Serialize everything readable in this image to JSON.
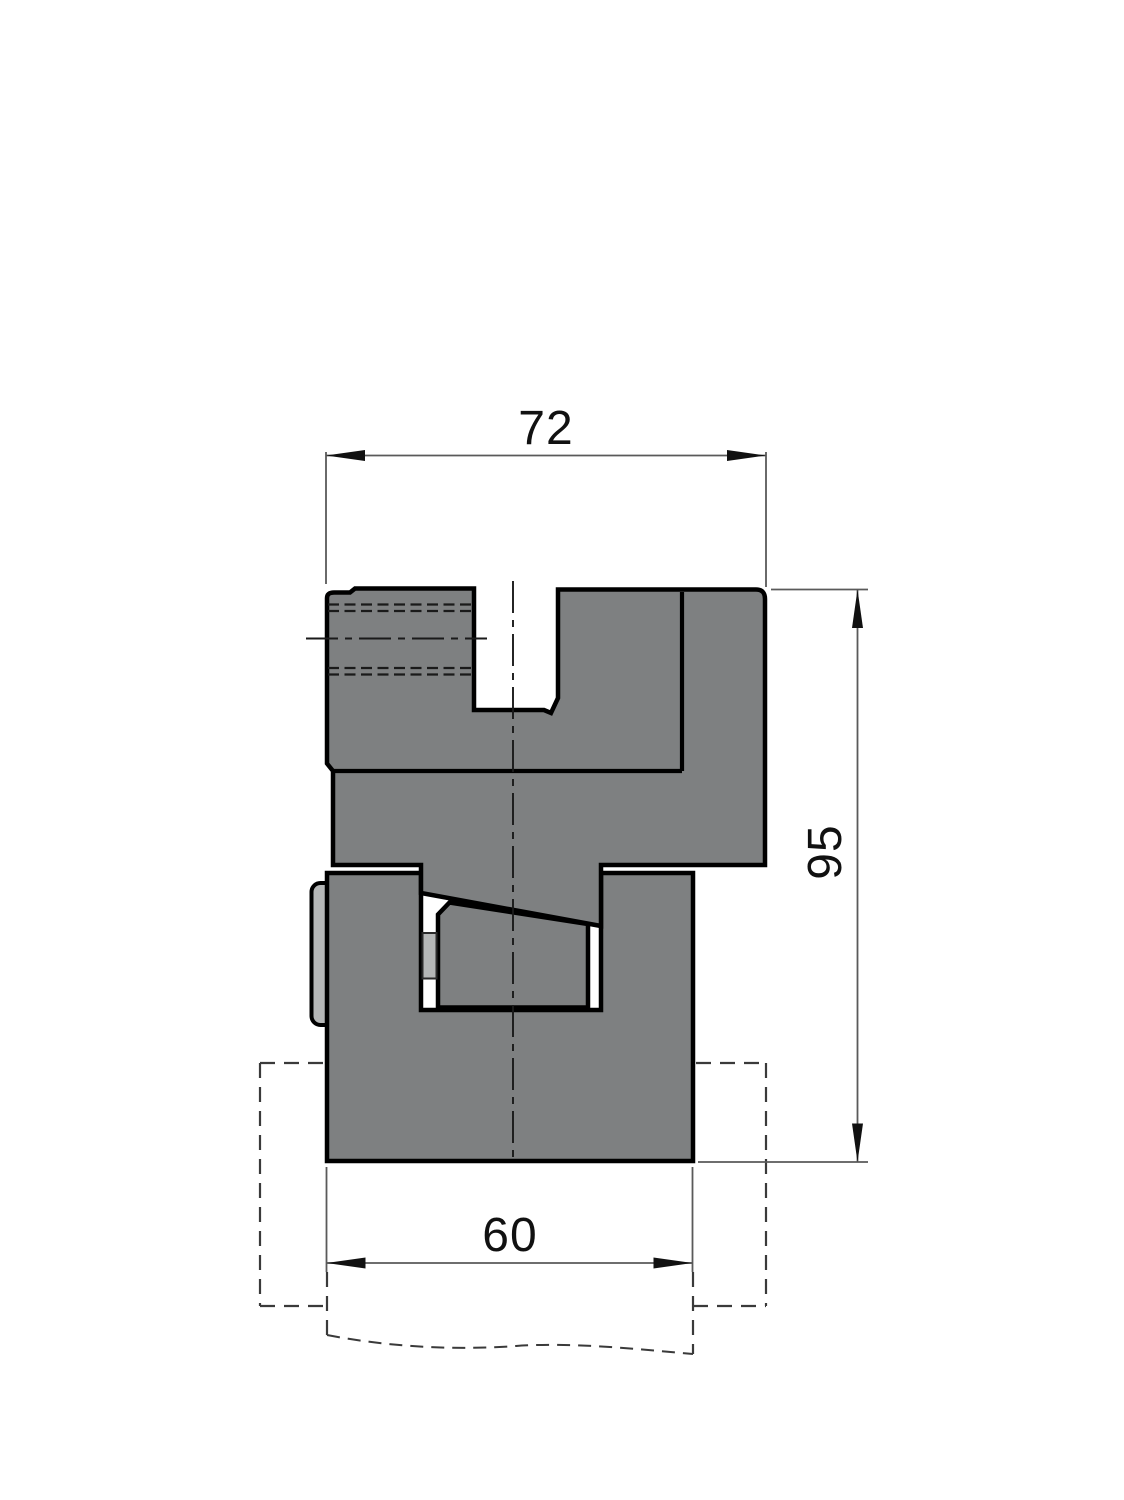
{
  "drawing": {
    "dimensions": {
      "top_width": "72",
      "right_height": "95",
      "bottom_width": "60"
    },
    "colors": {
      "body_fill": "#7e8081",
      "light_fill": "#b5b7b7",
      "outline": "#000000",
      "dim_line": "#5a5a5a",
      "hidden_line": "#3a3a3a",
      "text": "#111111",
      "background": "#ffffff"
    }
  }
}
